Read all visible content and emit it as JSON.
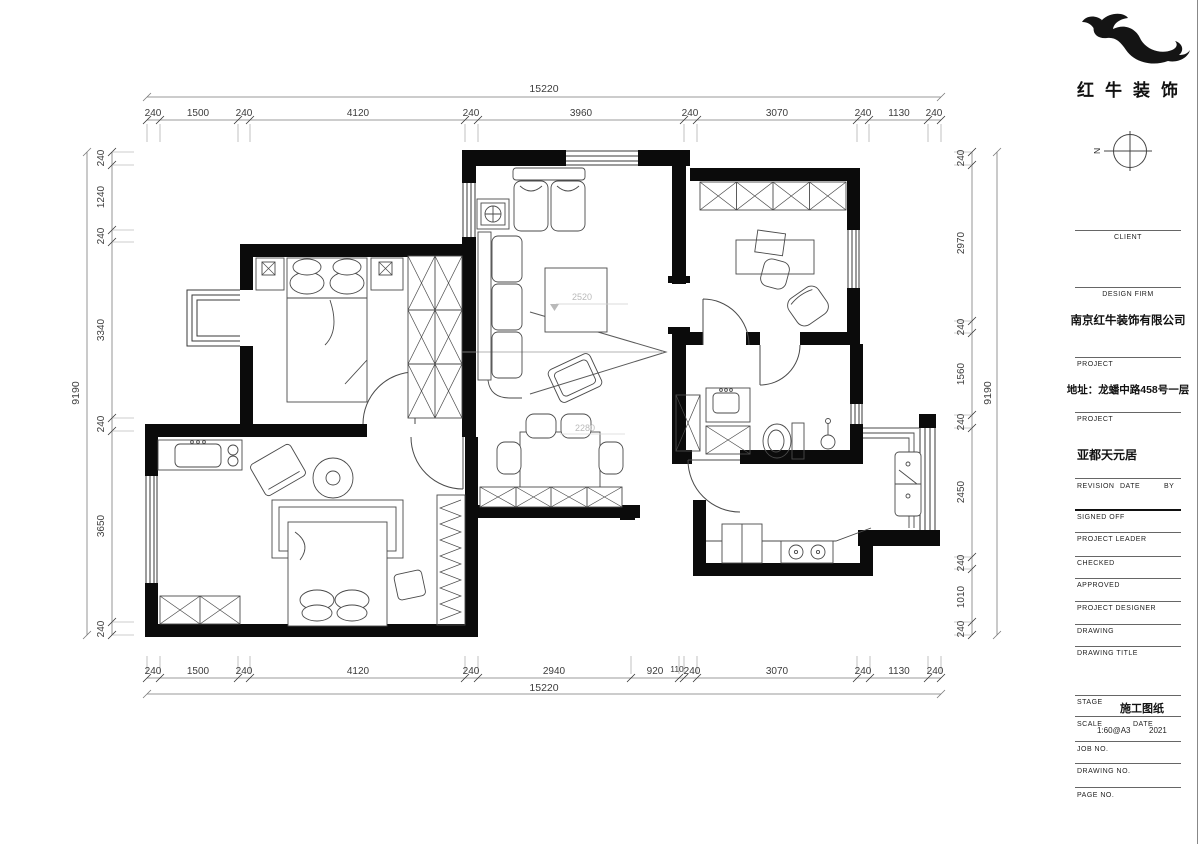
{
  "branding": {
    "logo_text": "红牛装饰",
    "compass_label": "N"
  },
  "title_block": {
    "client_label": "CLIENT",
    "design_firm_label": "DESIGN FIRM",
    "design_firm_value": "南京红牛装饰有限公司",
    "project_label_1": "PROJECT",
    "project_address": "地址：龙蟠中路458号一层",
    "project_label_2": "PROJECT",
    "project_name": "亚都天元居",
    "revision_label": "REVISION",
    "date_label": "DATE",
    "by_label": "BY",
    "signed_off_label": "SIGNED OFF",
    "project_leader_label": "PROJECT LEADER",
    "checked_label": "CHECKED",
    "approved_label": "APPROVED",
    "project_designer_label": "PROJECT DESIGNER",
    "drawing_label": "DRAWING",
    "drawing_title_label": "DRAWING TITLE",
    "stage_label": "STAGE",
    "stage_value": "施工图纸",
    "scale_label": "SCALE",
    "scale_value": "1:60@A3",
    "date_label_2": "DATE",
    "date_value": "2021",
    "job_no_label": "JOB NO.",
    "drawing_no_label": "DRAWING NO.",
    "page_no_label": "PAGE NO."
  },
  "dims": {
    "top_total": "15220",
    "bottom_total": "15220",
    "left_total": "9190",
    "right_total": "9190",
    "top": [
      "240",
      "1500",
      "240",
      "4120",
      "240",
      "3960",
      "240",
      "3070",
      "240",
      "1130",
      "240"
    ],
    "bottom": [
      "240",
      "1500",
      "240",
      "4120",
      "240",
      "2940",
      "920",
      "110",
      "240",
      "3070",
      "240",
      "1130",
      "240"
    ],
    "left": [
      "240",
      "1240",
      "240",
      "3340",
      "240",
      "3650",
      "240"
    ],
    "right": [
      "240",
      "2970",
      "240",
      "1560",
      "240",
      "2450",
      "240",
      "1010",
      "240"
    ]
  },
  "annotations": {
    "living_level": "2520",
    "dining_level": "2280"
  }
}
